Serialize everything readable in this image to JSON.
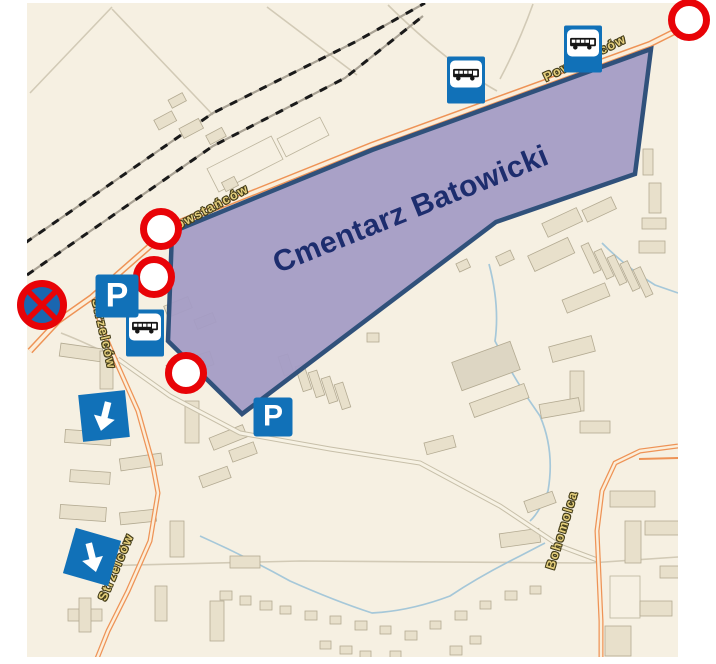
{
  "map": {
    "background_color": "#f6f0e2",
    "cemetery_label": "Cmentarz Batowicki",
    "street_labels": [
      {
        "text": "Powstańców",
        "x": 208,
        "y": 209,
        "angle": -28
      },
      {
        "text": "Powstańców",
        "x": 585,
        "y": 58,
        "angle": -26
      },
      {
        "text": "Strzelców",
        "x": 104,
        "y": 334,
        "angle": 77
      },
      {
        "text": "Strzelców",
        "x": 116,
        "y": 567,
        "angle": -67
      },
      {
        "text": "Bohomolca",
        "x": 562,
        "y": 530,
        "angle": -73
      }
    ],
    "signs": {
      "parking_label": "P"
    },
    "markers": {
      "red_circles": [
        {
          "x": 161,
          "y": 229
        },
        {
          "x": 154,
          "y": 277
        },
        {
          "x": 186,
          "y": 373
        },
        {
          "x": 689,
          "y": 20
        }
      ],
      "no_stopping": {
        "x": 42,
        "y": 305
      },
      "parking": [
        {
          "x": 117,
          "y": 296,
          "size": 43
        },
        {
          "x": 273,
          "y": 417,
          "size": 39
        }
      ],
      "bus_stops": [
        {
          "x": 145,
          "y": 333
        },
        {
          "x": 466,
          "y": 80
        },
        {
          "x": 583,
          "y": 49
        }
      ],
      "arrows": [
        {
          "x": 104,
          "y": 416,
          "box_angle": -6,
          "arrow_angle": 20
        },
        {
          "x": 92,
          "y": 557,
          "box_angle": 16,
          "arrow_angle": -30
        }
      ]
    },
    "colors": {
      "cemetery_fill": "#a49cc5",
      "cemetery_border": "#30517b",
      "cemetery_label_color": "#1d2d6e",
      "sign_blue": "#1171b8",
      "marker_red": "#e80307",
      "road_orange": "#ee9356",
      "street_label_fill": "#e5cf7d"
    }
  }
}
